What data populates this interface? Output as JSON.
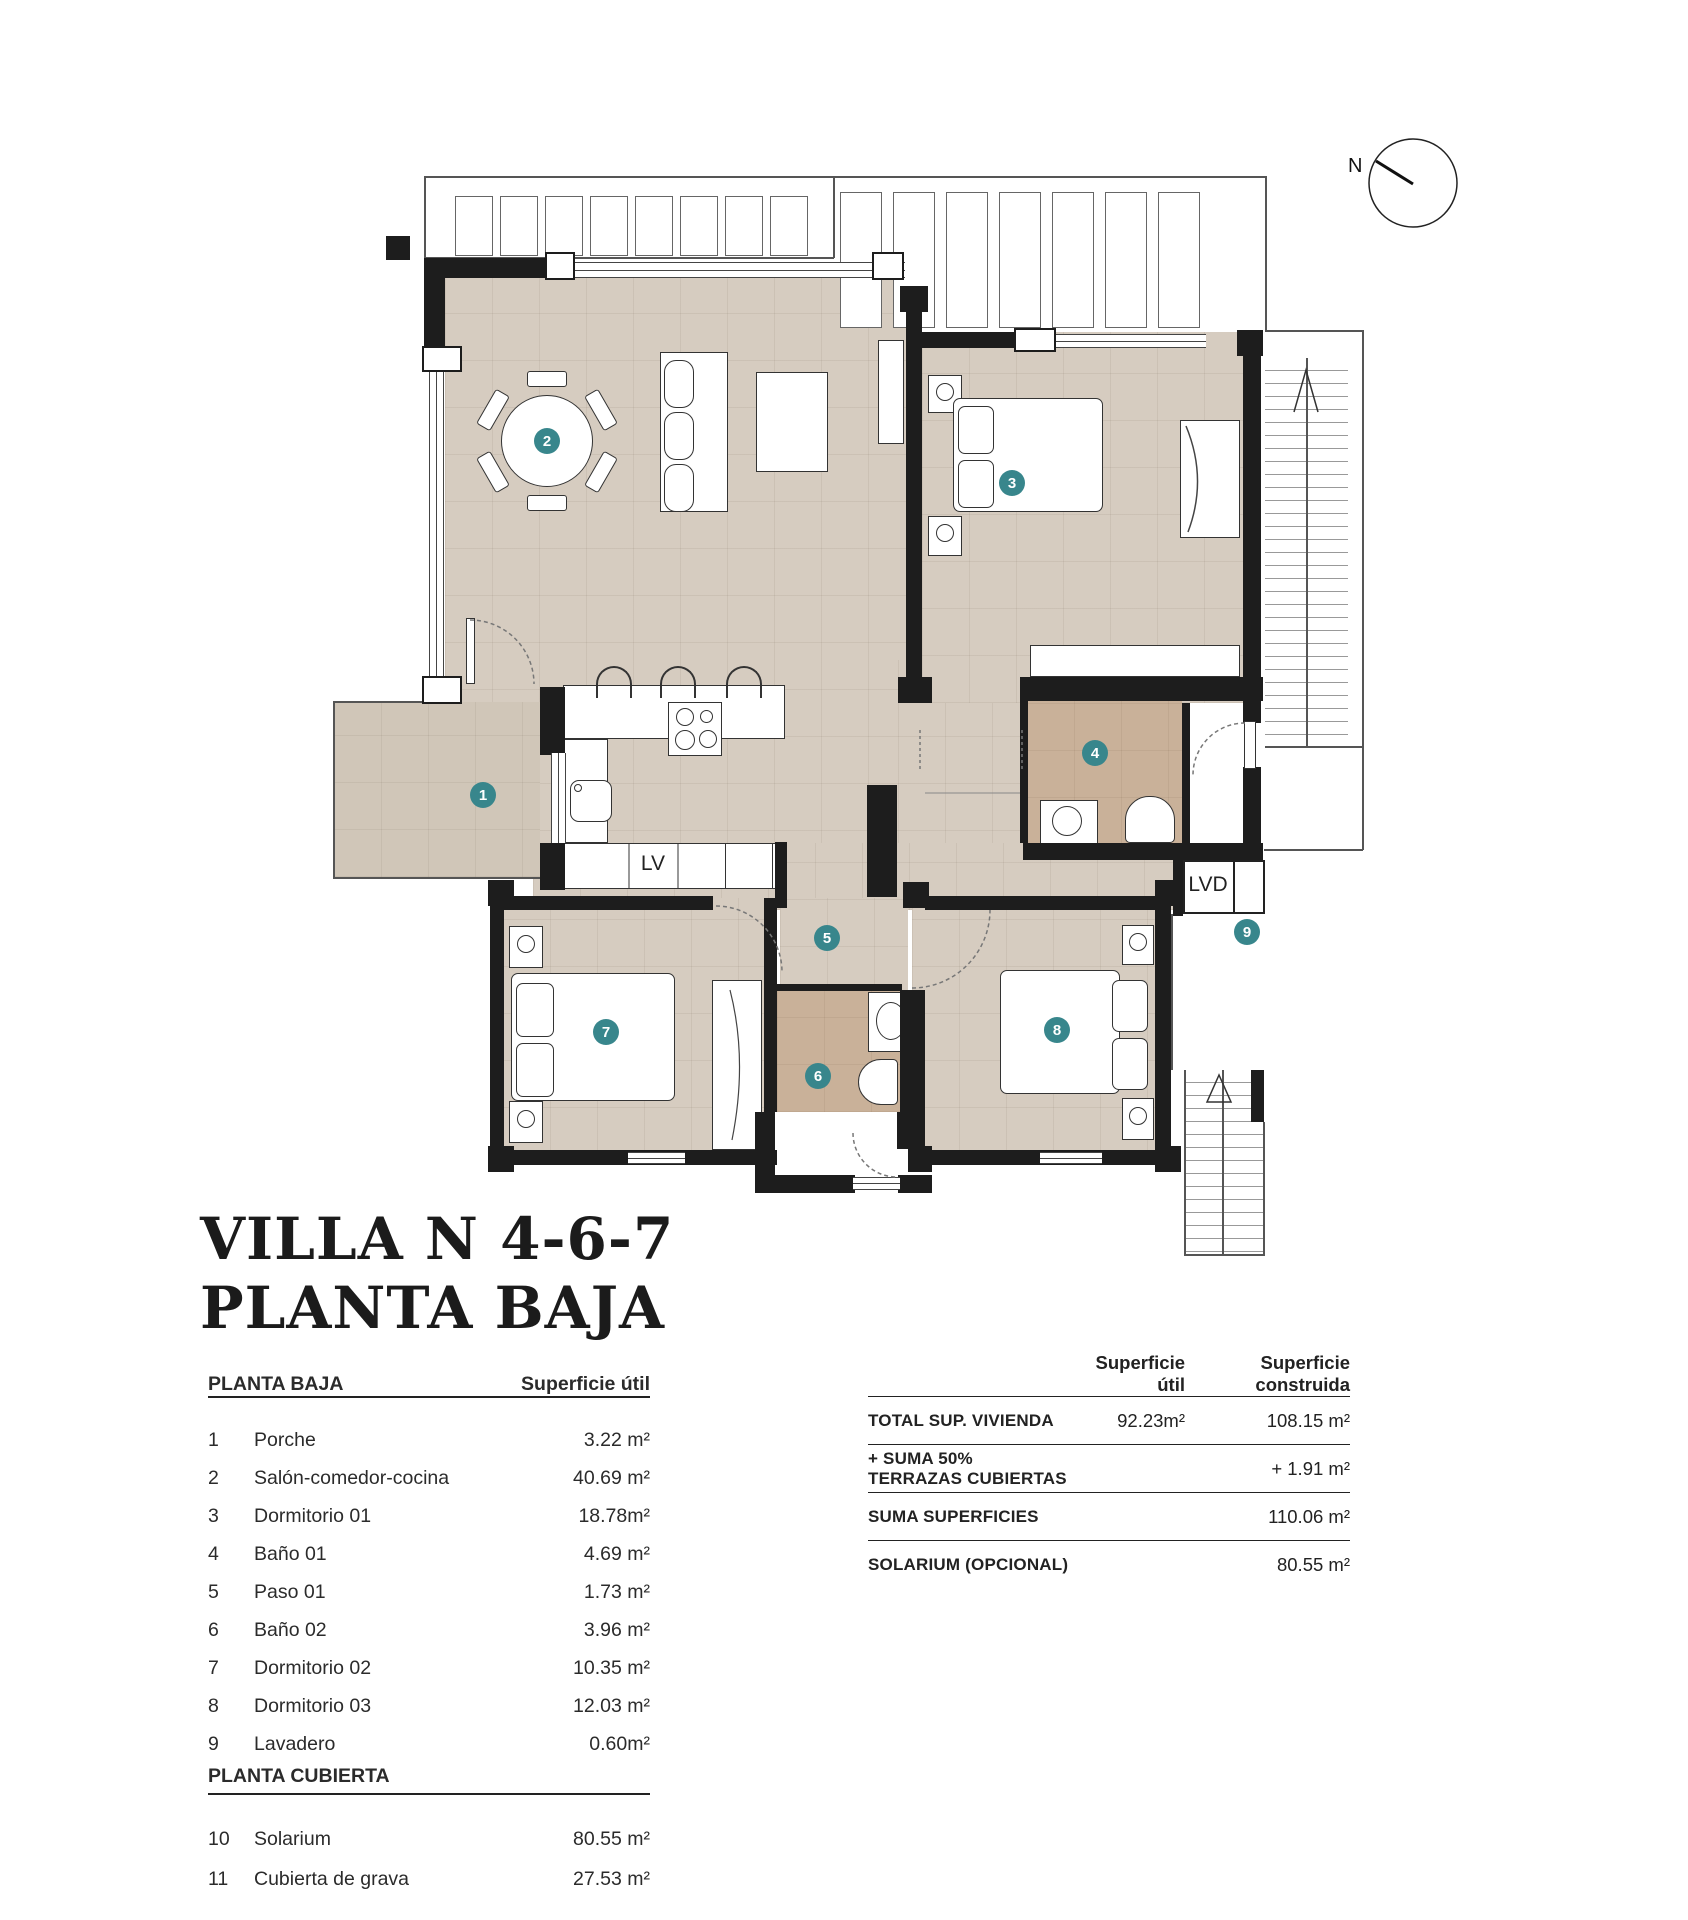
{
  "title": {
    "line1": "VILLA N 4-6-7",
    "line2": "PLANTA BAJA"
  },
  "plan": {
    "compass_n": "N",
    "lv": "LV",
    "lvd": "LVD",
    "room_numbers": [
      "1",
      "2",
      "3",
      "4",
      "5",
      "6",
      "7",
      "8",
      "9"
    ],
    "colors": {
      "accent_teal": "#38868c",
      "floor_beige": "#d6ccc0",
      "bath_tan": "#c9b199",
      "wall": "#1d1d1d"
    }
  },
  "left_table": {
    "section1": "PLANTA BAJA",
    "col_value": "Superficie útil",
    "rows1": [
      {
        "num": "1",
        "name": "Porche",
        "value": "3.22 m²"
      },
      {
        "num": "2",
        "name": "Salón-comedor-cocina",
        "value": "40.69 m²"
      },
      {
        "num": "3",
        "name": "Dormitorio 01",
        "value": "18.78m²"
      },
      {
        "num": "4",
        "name": "Baño 01",
        "value": "4.69 m²"
      },
      {
        "num": "5",
        "name": "Paso 01",
        "value": "1.73 m²"
      },
      {
        "num": "6",
        "name": "Baño 02",
        "value": "3.96 m²"
      },
      {
        "num": "7",
        "name": "Dormitorio 02",
        "value": "10.35 m²"
      },
      {
        "num": "8",
        "name": "Dormitorio 03",
        "value": "12.03 m²"
      },
      {
        "num": "9",
        "name": "Lavadero",
        "value": "0.60m²"
      }
    ],
    "section2": "PLANTA CUBIERTA",
    "rows2": [
      {
        "num": "10",
        "name": "Solarium",
        "value": "80.55 m²"
      },
      {
        "num": "11",
        "name": "Cubierta de grava",
        "value": "27.53 m²"
      }
    ]
  },
  "right_table": {
    "col1": "Superficie útil",
    "col2": "Superficie construida",
    "rows": [
      {
        "label": "TOTAL SUP. VIVIENDA",
        "util": "92.23m²",
        "construida": "108.15 m²"
      },
      {
        "label": "+ SUMA 50% TERRAZAS CUBIERTAS",
        "util": "",
        "construida": "+ 1.91 m²"
      },
      {
        "label": "SUMA SUPERFICIES",
        "util": "",
        "construida": "110.06 m²"
      },
      {
        "label": "SOLARIUM (OPCIONAL)",
        "util": "",
        "construida": "80.55 m²"
      }
    ]
  }
}
